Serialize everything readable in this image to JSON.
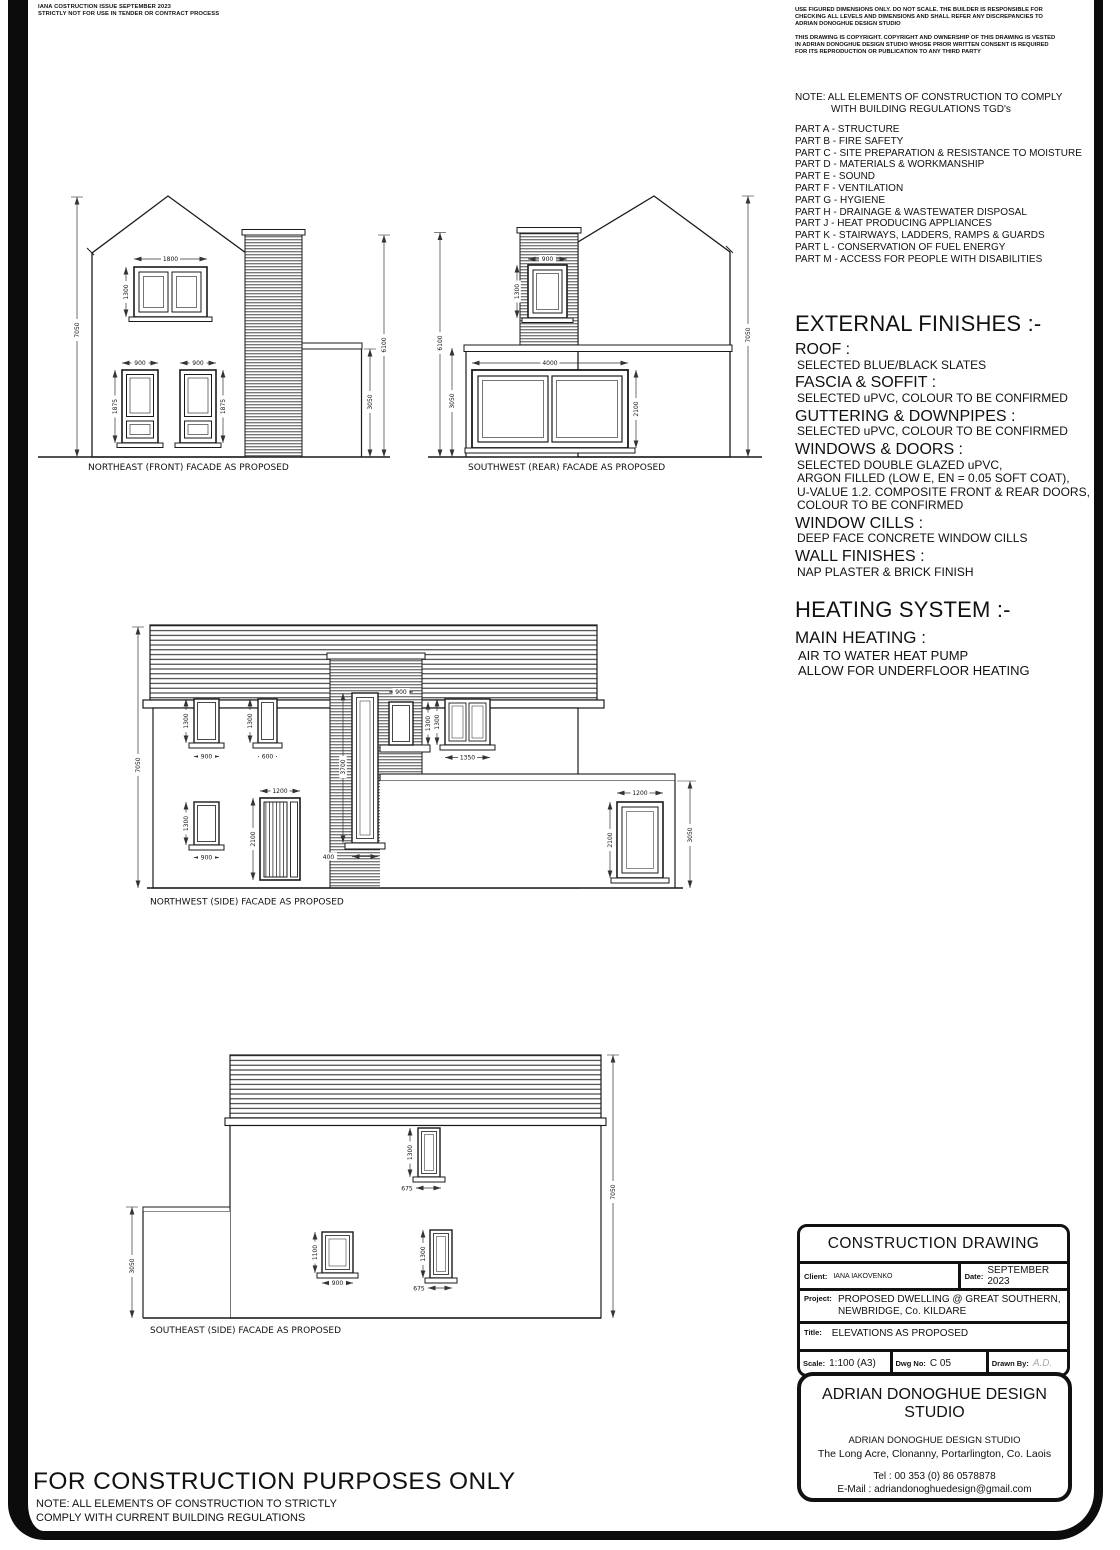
{
  "page": {
    "corner_note_1": "IANA COSTRUCTION ISSUE SEPTEMBER 2023",
    "corner_note_2": "STRICTLY NOT FOR USE IN TENDER OR CONTRACT PROCESS",
    "disclaimer_1": "USE FIGURED DIMENSIONS ONLY.  DO NOT SCALE.  THE BUILDER IS RESPONSIBLE FOR CHECKING ALL LEVELS AND DIMENSIONS AND SHALL REFER ANY DISCREPANCIES TO ADRIAN DONOGHUE DESIGN STUDIO",
    "disclaimer_2": "THIS DRAWING IS COPYRIGHT.  COPYRIGHT AND OWNERSHIP OF THIS DRAWING IS VESTED IN ADRIAN DONOGHUE DESIGN STUDIO WHOSE PRIOR WRITTEN CONSENT IS REQUIRED FOR ITS REPRODUCTION OR PUBLICATION TO ANY THIRD PARTY",
    "footer_title": "FOR CONSTRUCTION PURPOSES ONLY",
    "footer_note_1": "NOTE: ALL ELEMENTS OF CONSTRUCTION TO STRICTLY",
    "footer_note_2": "COMPLY WITH CURRENT BUILDING REGULATIONS"
  },
  "regulations": {
    "note_1": "NOTE: ALL ELEMENTS OF CONSTRUCTION TO COMPLY",
    "note_2": "WITH BUILDING REGULATIONS TGD's",
    "parts": [
      "PART A - STRUCTURE",
      "PART B - FIRE SAFETY",
      "PART C - SITE PREPARATION & RESISTANCE TO MOISTURE",
      "PART D - MATERIALS & WORKMANSHIP",
      "PART E - SOUND",
      "PART F - VENTILATION",
      "PART G - HYGIENE",
      "PART H - DRAINAGE & WASTEWATER DISPOSAL",
      "PART J - HEAT PRODUCING APPLIANCES",
      "PART K - STAIRWAYS, LADDERS, RAMPS & GUARDS",
      "PART L - CONSERVATION OF FUEL ENERGY",
      "PART M - ACCESS FOR PEOPLE WITH DISABILITIES"
    ]
  },
  "finishes": {
    "heading": "EXTERNAL FINISHES :-",
    "roof_label": "ROOF :",
    "roof_value": "SELECTED BLUE/BLACK SLATES",
    "fascia_label": "FASCIA & SOFFIT :",
    "fascia_value": "SELECTED uPVC, COLOUR TO BE CONFIRMED",
    "gutter_label": "GUTTERING & DOWNPIPES :",
    "gutter_value": "SELECTED uPVC, COLOUR TO BE CONFIRMED",
    "windows_label": "WINDOWS & DOORS :",
    "windows_value_1": "SELECTED DOUBLE GLAZED uPVC,",
    "windows_value_2": "ARGON FILLED (LOW E, EN = 0.05 SOFT COAT),",
    "windows_value_3": "U-VALUE 1.2. COMPOSITE FRONT & REAR DOORS,",
    "windows_value_4": "COLOUR TO BE CONFIRMED",
    "cills_label": "WINDOW CILLS :",
    "cills_value": "DEEP FACE CONCRETE WINDOW CILLS",
    "wall_label": "WALL FINISHES :",
    "wall_value": "NAP PLASTER & BRICK FINISH"
  },
  "heating": {
    "heading": "HEATING SYSTEM :-",
    "sub": "MAIN HEATING :",
    "line_1": "AIR TO WATER HEAT PUMP",
    "line_2": "ALLOW FOR UNDERFLOOR HEATING"
  },
  "title_block": {
    "header": "CONSTRUCTION DRAWING",
    "client_label": "Client:",
    "client": "IANA IAKOVENKO",
    "date_label": "Date:",
    "date": "SEPTEMBER 2023",
    "project_label": "Project:",
    "project_1": "PROPOSED DWELLING @ GREAT SOUTHERN,",
    "project_2": "NEWBRIDGE, Co. KILDARE",
    "title_label": "Title:",
    "title": "ELEVATIONS AS PROPOSED",
    "scale_label": "Scale:",
    "scale": "1:100 (A3)",
    "dwg_label": "Dwg No:",
    "dwg": "C 05",
    "drawn_label": "Drawn By:",
    "drawn": "A.D."
  },
  "studio": {
    "heading": "ADRIAN DONOGHUE DESIGN STUDIO",
    "name": "ADRIAN DONOGHUE DESIGN STUDIO",
    "address": "The Long Acre, Clonanny, Portarlington, Co. Laois",
    "tel": "Tel : 00 353 (0) 86 0578878",
    "email": "E-Mail : adriandonoghuedesign@gmail.com"
  },
  "facades": {
    "ne": {
      "label": "NORTHEAST (FRONT) FACADE AS PROPOSED",
      "dims": {
        "overall": "7050",
        "top_w": "1800",
        "top_h": "1300",
        "low1_w": "900",
        "low1_h": "1875",
        "low2_w": "900",
        "low2_h": "1875",
        "right_upper": "6100",
        "right_lower": "3050"
      }
    },
    "sw": {
      "label": "SOUTHWEST (REAR) FACADE AS PROPOSED",
      "dims": {
        "left_upper": "6100",
        "left_lower": "3050",
        "col_w": "900",
        "col_h": "1300",
        "big_w": "4000",
        "big_h": "2100",
        "overall": "7050"
      }
    },
    "nw": {
      "label": "NORTHWEST (SIDE) FACADE AS PROPOSED",
      "dims": {
        "overall": "7050",
        "w1_h": "1300",
        "w1_w": "900",
        "w2_h": "1300",
        "w2_w": "600",
        "slot_h": "3700",
        "slot_w": "400",
        "w3_w": "900",
        "w3_h": "1300",
        "w4_h": "1300",
        "w4_w": "1350",
        "w5_h": "1300",
        "w5_w": "900",
        "door_w": "1200",
        "door_h": "2100",
        "w6_w": "1200",
        "w6_h": "2100",
        "ext_h": "3050"
      }
    },
    "se": {
      "label": "SOUTHEAST (SIDE) FACADE AS PROPOSED",
      "dims": {
        "left_h": "3050",
        "overall": "7050",
        "top_h": "1300",
        "top_w": "675",
        "b1_h": "1100",
        "b1_w": "900",
        "b2_h": "1300",
        "b2_w": "675"
      }
    }
  }
}
